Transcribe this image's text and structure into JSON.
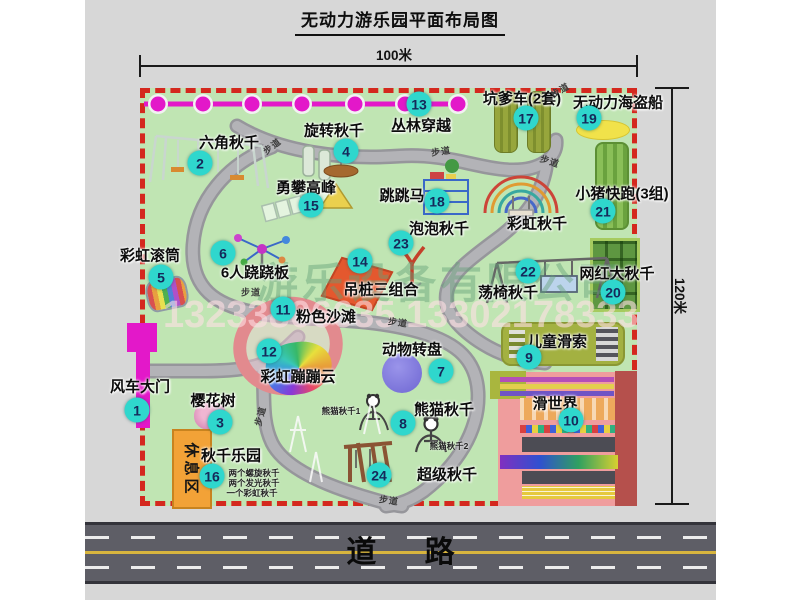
{
  "title": "无动力游乐园平面布局图",
  "dimensions": {
    "top": "100米",
    "right": "120米"
  },
  "road_label": "道  路",
  "rest_area_label": "休息区",
  "path_label_text": "步道",
  "watermark": {
    "company": "游乐设备有限公司",
    "phone": "13233806635 13302178333"
  },
  "colors": {
    "park": "#c0e5b3",
    "red": "#d4281e",
    "badge": "#2fd7cd",
    "badgeText": "#15295a",
    "magenta": "#e318c9",
    "roadbg": "#5e5e66",
    "yellowline": "#d8b53e",
    "orange": "#f2a237",
    "pathgray": "#a5a5aa"
  },
  "attractions": [
    {
      "num": "1",
      "label": "风车大门",
      "lx": 140,
      "ly": 386,
      "bx": 137,
      "by": 410
    },
    {
      "num": "2",
      "label": "六角秋千",
      "lx": 229,
      "ly": 142,
      "bx": 200,
      "by": 163
    },
    {
      "num": "3",
      "label": "樱花树",
      "lx": 213,
      "ly": 400,
      "bx": 220,
      "by": 422
    },
    {
      "num": "4",
      "label": "旋转秋千",
      "lx": 334,
      "ly": 130,
      "bx": 346,
      "by": 151
    },
    {
      "num": "5",
      "label": "彩虹滚筒",
      "lx": 150,
      "ly": 255,
      "bx": 161,
      "by": 277
    },
    {
      "num": "6",
      "label": "6人跷跷板",
      "lx": 255,
      "ly": 272,
      "bx": 223,
      "by": 253
    },
    {
      "num": "7",
      "label": "动物转盘",
      "lx": 412,
      "ly": 349,
      "bx": 441,
      "by": 371
    },
    {
      "num": "8",
      "label": "熊猫秋千",
      "lx": 444,
      "ly": 409,
      "bx": 403,
      "by": 423
    },
    {
      "num": "9",
      "label": "儿童滑索",
      "lx": 557,
      "ly": 341,
      "bx": 529,
      "by": 357
    },
    {
      "num": "10",
      "label": "滑世界",
      "lx": 555,
      "ly": 403,
      "bx": 571,
      "by": 420
    },
    {
      "num": "11",
      "label": "粉色沙滩",
      "lx": 326,
      "ly": 316,
      "bx": 283,
      "by": 309
    },
    {
      "num": "12",
      "label": "彩虹蹦蹦云",
      "lx": 298,
      "ly": 376,
      "bx": 269,
      "by": 351
    },
    {
      "num": "13",
      "label": "丛林穿越",
      "lx": 421,
      "ly": 125,
      "bx": 419,
      "by": 104
    },
    {
      "num": "14",
      "label": "吊桩三组合",
      "lx": 381,
      "ly": 289,
      "bx": 360,
      "by": 261
    },
    {
      "num": "15",
      "label": "勇攀高峰",
      "lx": 306,
      "ly": 187,
      "bx": 311,
      "by": 205
    },
    {
      "num": "16",
      "label": "秋千乐园",
      "lx": 231,
      "ly": 455,
      "bx": 212,
      "by": 476
    },
    {
      "num": "17",
      "label": "坑爹车(2套)",
      "lx": 522,
      "ly": 98,
      "bx": 526,
      "by": 118
    },
    {
      "num": "18",
      "label": "跳跳马",
      "lx": 402,
      "ly": 195,
      "bx": 437,
      "by": 201
    },
    {
      "num": "19",
      "label": "无动力海盗船",
      "lx": 618,
      "ly": 102,
      "bx": 589,
      "by": 118
    },
    {
      "num": "20",
      "label": "网红大秋千",
      "lx": 617,
      "ly": 273,
      "bx": 613,
      "by": 292
    },
    {
      "num": "21",
      "label": "小猪快跑(3组)",
      "lx": 622,
      "ly": 193,
      "bx": 603,
      "by": 211
    },
    {
      "num": "22",
      "label": "荡椅秋千",
      "lx": 508,
      "ly": 292,
      "bx": 528,
      "by": 271
    },
    {
      "num": "23",
      "label": "泡泡秋千",
      "lx": 439,
      "ly": 228,
      "bx": 401,
      "by": 243
    },
    {
      "num": "24",
      "label": "超级秋千",
      "lx": 447,
      "ly": 474,
      "bx": 379,
      "by": 475
    },
    {
      "num": "",
      "label": "彩虹秋千",
      "lx": 537,
      "ly": 223,
      "bx": 0,
      "by": 0
    }
  ],
  "small_labels": [
    {
      "text": "熊猫秋千1",
      "x": 341,
      "y": 411
    },
    {
      "text": "熊猫秋千2",
      "x": 449,
      "y": 446
    },
    {
      "text": "两个螺旋秋千",
      "x": 254,
      "y": 473
    },
    {
      "text": "两个发光秋千",
      "x": 254,
      "y": 483
    },
    {
      "text": "一个彩虹秋千",
      "x": 252,
      "y": 493
    }
  ],
  "path_labels": [
    {
      "x": 272,
      "y": 146,
      "r": -38
    },
    {
      "x": 441,
      "y": 151,
      "r": -8
    },
    {
      "x": 550,
      "y": 161,
      "r": 18
    },
    {
      "x": 560,
      "y": 90,
      "r": -30
    },
    {
      "x": 251,
      "y": 292,
      "r": 0
    },
    {
      "x": 398,
      "y": 322,
      "r": 8
    },
    {
      "x": 260,
      "y": 416,
      "r": -75
    },
    {
      "x": 389,
      "y": 500,
      "r": 8
    }
  ],
  "chain": {
    "y": 104,
    "x_start": 144,
    "x_end": 468,
    "dots": [
      158,
      203,
      252,
      302,
      355,
      405,
      458
    ]
  }
}
